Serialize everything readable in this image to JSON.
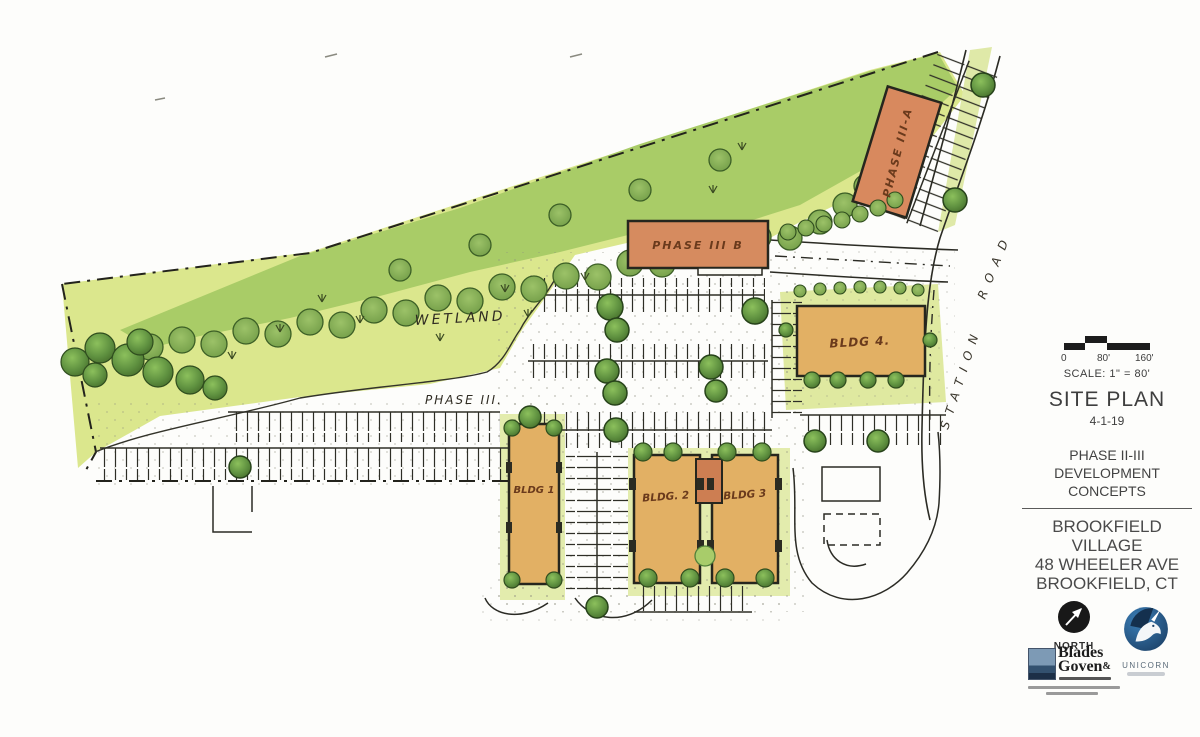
{
  "plan": {
    "wetland_label": "WETLAND",
    "phase_area_label": "PHASE III.",
    "street_name_upper": "ROAD",
    "street_name_lower": "STATION",
    "buildings": {
      "phase3a": "PHASE III-A",
      "phase3b": "PHASE III B",
      "bldg1": "BLDG 1",
      "bldg2": "BLDG. 2",
      "bldg3": "BLDG 3",
      "bldg4": "BLDG 4."
    }
  },
  "titleblock": {
    "scale_tick_0": "0",
    "scale_tick_80": "80'",
    "scale_tick_160": "160'",
    "scale_label": "SCALE: 1\" = 80'",
    "title": "SITE PLAN",
    "date": "4-1-19",
    "phase_line1": "PHASE II-III",
    "phase_line2": "DEVELOPMENT",
    "phase_line3": "CONCEPTS",
    "project_line1": "BROOKFIELD",
    "project_line2": "VILLAGE",
    "project_line3": "48 WHEELER AVE",
    "project_line4": "BROOKFIELD, CT",
    "north_label": "NORTH",
    "blades_line1": "Blades",
    "blades_amp": "&",
    "blades_line2": "Goven",
    "unicorn_label": "UNICORN"
  },
  "colors": {
    "wetland_green": "#dbe78d",
    "forest_green": "#a9cc67",
    "tree_green": "#4e7c31",
    "building_salmon": "#d68b5f",
    "building_tan": "#e2b064",
    "ink": "#2b2b24"
  }
}
